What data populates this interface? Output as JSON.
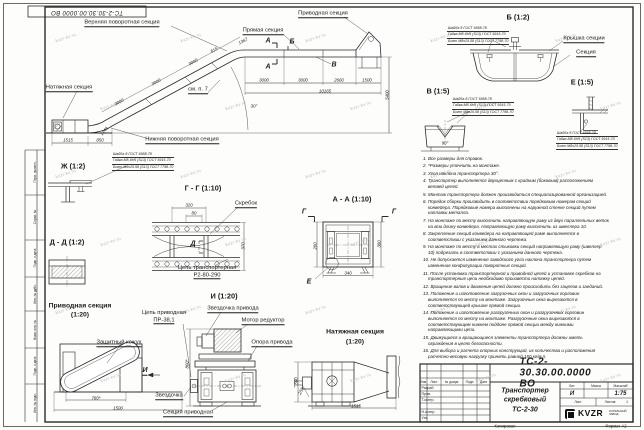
{
  "sheet": {
    "stamp_top": "ТС-2-30.30.00.0000 ВО",
    "copied_label": "Копировал",
    "format_label": "Формат А2",
    "watermark": "kvzr-kv.ru",
    "line_color": "#2b2b2b",
    "margin_labels": [
      {
        "label": "Перв. примен.",
        "y": 172
      },
      {
        "label": "Справ. №",
        "y": 217
      },
      {
        "label": "Подп. и дата",
        "y": 258
      },
      {
        "label": "Инв. № дубл.",
        "y": 294
      },
      {
        "label": "Взам. инв. №",
        "y": 330
      },
      {
        "label": "Подп. и дата",
        "y": 366
      },
      {
        "label": "Инв. № подл.",
        "y": 403
      }
    ]
  },
  "title_block": {
    "doc_number": "ТС-2-30.30.00.0000  ВО",
    "title_lines": [
      "Транспортер",
      "скребковый",
      "ТС-2-30"
    ],
    "header_cells": [
      "Изм.",
      "Лист",
      "№ докум.",
      "Подп.",
      "Дата"
    ],
    "row_labels": [
      "Разраб.",
      "Пров.",
      "Т.контр.",
      "Н.контр.",
      "Утв."
    ],
    "lit_label": "Лит.",
    "lit_value": "И",
    "mass_label": "Масса",
    "scale_label": "Масштаб",
    "scale_value": "1:75",
    "sheet_label": "Лист",
    "sheets_label": "Листов",
    "sheets_value": "1",
    "company": "KVZR",
    "company_sub_lines": [
      "КОТЕЛЬНЫЙ",
      "ЗАВОД"
    ]
  },
  "fastener_callout": [
    "Шайба 8 ГОСТ 6958-78",
    "Гайка М8-6Н5 (S13) ГОСТ 5915-70",
    "Болт М8х25.58 (S13) ГОСТ 7798-70"
  ],
  "callout_positions": [
    {
      "n": "callout-detail-b",
      "x": 447,
      "y": 26
    },
    {
      "n": "callout-detail-v",
      "x": 452,
      "y": 97
    },
    {
      "n": "callout-detail-e",
      "x": 556,
      "y": 131
    },
    {
      "n": "callout-detail-zh",
      "x": 112,
      "y": 152
    }
  ],
  "notes": [
    "1. Все размеры для справок.",
    "2. *Размеры уточнить на монтаже.",
    "3. Угол наклона транспортера 30°.",
    "4. Транспортер выполняется двухцепным с крайним (боковым) расположением ветвей цепей.",
    "5. Монтаж транспортера должен производиться специализированной организацией.",
    "6. Порядок сборки производить в соответствии порядковым номерам секций конвейера. Порядковые номера выполнены на наружной стенке секций путем наплавки металла.",
    "7. На монтаже по месту выполнить направляющую раму из двух параллельных веток на всю длину конвейера. Направляющую раму выполнить из швеллера 10.",
    "8. Закрепление секций конвейера на направляющей раме выполняется в соответствии с указанием данного чертежа.",
    "9. На монтаже по месту в местах стыковки секций направляющую раму (швеллер 10) подрезать в соответствии с указанием данного чертежа.",
    "10. Не допускается изменение заводского угла наклона транспортера путем изменения конфигурации поворотных секций.",
    "11. После установки транспортерной и приводной цепей и установке скребков на транспортерные цепи необходимо произвести натяжку цепей.",
    "12. Вращение валов и движение цепей должно происходить без зацепов и заеданий.",
    "13. Положение и изготовление загрузочных окон и загрузочных горловин выполняется по месту на монтаже. Загрузочные окна вырезаются в соответствующей крышке прямой секции.",
    "14. Положение и изготовление разгрузочных окон и разгрузочных горловин выполняется по месту на монтаже. Разгрузочные окна вырезаются в соответствующем нижнем поддоне прямой секции между нижними направляющими цепи.",
    "15. Движущиеся и вращающиеся элементы транспортера должны иметь ограждения в целях безопасности.",
    "16. Для выбора и расчета опорных конструкций, их количества и расположения расчетно-весовую нагрузку принять равной 150 кг/м.п."
  ],
  "annotations": [
    {
      "n": "label-upper-turn-section",
      "t": "Верхняя поворотная секция",
      "x": 122,
      "y": 23,
      "c": "lbl",
      "u": 1
    },
    {
      "n": "label-drive-section-main",
      "t": "Приводная секция",
      "x": 323,
      "y": 14,
      "c": "lbl",
      "u": 1
    },
    {
      "n": "label-straight-section",
      "t": "Прямая секция",
      "x": 263,
      "y": 31,
      "c": "lbl",
      "u": 1
    },
    {
      "n": "label-tension-section-main",
      "t": "Натяжная секция",
      "x": 69,
      "y": 88,
      "c": "lbl",
      "u": 1
    },
    {
      "n": "label-lower-turn-section",
      "t": "Нижняя поворотная секция",
      "x": 182,
      "y": 140,
      "c": "lbl",
      "u": 1
    },
    {
      "n": "ref-see-note-7",
      "t": "см. п. 7",
      "x": 198,
      "y": 90,
      "c": "lbl",
      "u": 1
    },
    {
      "n": "marker-a-top",
      "t": "А",
      "x": 268,
      "y": 41,
      "c": "mk"
    },
    {
      "n": "marker-a-bottom",
      "t": "А",
      "x": 268,
      "y": 67,
      "c": "mk"
    },
    {
      "n": "marker-b",
      "t": "Б",
      "x": 292,
      "y": 42,
      "c": "mk"
    },
    {
      "n": "marker-v",
      "t": "В",
      "x": 334,
      "y": 65,
      "c": "mk"
    },
    {
      "n": "dim-incline-3000-1",
      "t": "3000",
      "x": 119,
      "y": 102,
      "r": -28,
      "c": "dim"
    },
    {
      "n": "dim-incline-3000-2",
      "t": "3000",
      "x": 156,
      "y": 82,
      "r": -28,
      "c": "dim"
    },
    {
      "n": "dim-incline-3000-3",
      "t": "3000",
      "x": 193,
      "y": 62,
      "r": -28,
      "c": "dim"
    },
    {
      "n": "dim-615",
      "t": "615",
      "x": 214,
      "y": 50,
      "r": -28,
      "c": "dim"
    },
    {
      "n": "dim-1367",
      "t": "1367",
      "x": 243,
      "y": 41,
      "r": -28,
      "c": "dim"
    },
    {
      "n": "dim-1515-main",
      "t": "1515",
      "x": 68,
      "y": 140,
      "c": "dim"
    },
    {
      "n": "dim-850",
      "t": "850",
      "x": 100,
      "y": 140,
      "c": "dim"
    },
    {
      "n": "dim-1249",
      "t": "1249",
      "x": 104,
      "y": 131,
      "r": -50,
      "c": "dim"
    },
    {
      "n": "dim-straight-3000-1",
      "t": "3000",
      "x": 264,
      "y": 80,
      "c": "dim"
    },
    {
      "n": "dim-straight-3000-2",
      "t": "3000",
      "x": 303,
      "y": 80,
      "c": "dim"
    },
    {
      "n": "dim-2660",
      "t": "2660",
      "x": 339,
      "y": 80,
      "c": "dim"
    },
    {
      "n": "dim-1500-main",
      "t": "1500",
      "x": 367,
      "y": 80,
      "c": "dim"
    },
    {
      "n": "dim-10165",
      "t": "10165",
      "x": 325,
      "y": 90.5,
      "c": "dim"
    },
    {
      "n": "dim-5400",
      "t": "5400",
      "x": 387,
      "y": 95,
      "r": -90,
      "c": "dim"
    },
    {
      "n": "dim-angle-30",
      "t": "30°",
      "x": 254,
      "y": 106,
      "c": "dim"
    },
    {
      "n": "title-detail-b",
      "t": "Б (1:2)",
      "x": 518,
      "y": 17,
      "c": "ttl"
    },
    {
      "n": "label-section-cover",
      "t": "Крышка секции",
      "x": 584,
      "y": 39,
      "c": "lbl",
      "u": 1
    },
    {
      "n": "label-section",
      "t": "Секция",
      "x": 586,
      "y": 53,
      "c": "lbl",
      "u": 1
    },
    {
      "n": "title-detail-v",
      "t": "В (1:5)",
      "x": 438,
      "y": 91,
      "c": "ttl"
    },
    {
      "n": "dim-angle-90",
      "t": "90°",
      "x": 445,
      "y": 143,
      "c": "dim"
    },
    {
      "n": "title-detail-e",
      "t": "Е (1:5)",
      "x": 582,
      "y": 82,
      "c": "ttl"
    },
    {
      "n": "title-detail-zh",
      "t": "Ж (1:2)",
      "x": 73,
      "y": 166,
      "c": "ttl"
    },
    {
      "n": "title-section-gg",
      "t": "Г - Г (1:10)",
      "x": 203,
      "y": 188,
      "c": "ttl"
    },
    {
      "n": "label-scraper",
      "t": "Скребок",
      "x": 246,
      "y": 204,
      "c": "lbl",
      "u": 1
    },
    {
      "n": "label-conveyor-chain-1",
      "t": "Цепь транспортерная",
      "x": 207,
      "y": 268,
      "c": "lbl"
    },
    {
      "n": "label-conveyor-chain-2",
      "t": "Р2-80-290",
      "x": 207,
      "y": 275.5,
      "c": "lbl",
      "u": 1
    },
    {
      "n": "dim-320",
      "t": "320",
      "x": 189,
      "y": 205,
      "c": "dim"
    },
    {
      "n": "dim-80",
      "t": "80",
      "x": 194,
      "y": 213,
      "c": "dim"
    },
    {
      "n": "dim-370",
      "t": "370",
      "x": 242.5,
      "y": 246,
      "r": -90,
      "c": "dim"
    },
    {
      "n": "marker-d",
      "t": "Д",
      "x": 193,
      "y": 244,
      "c": "mk"
    },
    {
      "n": "title-section-dd",
      "t": "Д - Д (1:2)",
      "x": 67,
      "y": 242,
      "c": "ttl"
    },
    {
      "n": "title-section-aa",
      "t": "А - А (1:10)",
      "x": 352,
      "y": 199,
      "c": "ttl"
    },
    {
      "n": "marker-g-left",
      "t": "Г",
      "x": 304,
      "y": 212,
      "c": "mk"
    },
    {
      "n": "marker-g-right",
      "t": "Г",
      "x": 394,
      "y": 212,
      "c": "mk"
    },
    {
      "n": "marker-e-detail",
      "t": "Е",
      "x": 309,
      "y": 282,
      "c": "mk"
    },
    {
      "n": "dim-200",
      "t": "200",
      "x": 314.5,
      "y": 246,
      "r": -90,
      "c": "dim"
    },
    {
      "n": "dim-360",
      "t": "360",
      "x": 378.5,
      "y": 244,
      "r": -90,
      "c": "dim"
    },
    {
      "n": "dim-340",
      "t": "340",
      "x": 348,
      "y": 273,
      "c": "dim"
    },
    {
      "n": "title-drive-view-1",
      "t": "Приводная секция",
      "x": 80,
      "y": 306,
      "c": "ttl2"
    },
    {
      "n": "title-drive-view-2",
      "t": "(1:20)",
      "x": 80,
      "y": 315,
      "c": "ttl2"
    },
    {
      "n": "label-protective-casing",
      "t": "Защитный кожух",
      "x": 119,
      "y": 343,
      "c": "lbl",
      "u": 1
    },
    {
      "n": "dim-780",
      "t": "780*",
      "x": 96,
      "y": 397.5,
      "c": "dim"
    },
    {
      "n": "dim-1500-drive",
      "t": "1500",
      "x": 118,
      "y": 407.5,
      "c": "dim"
    },
    {
      "n": "marker-i-arrow",
      "t": "И",
      "x": 145,
      "y": 371,
      "c": "mk",
      "u": 1
    },
    {
      "n": "title-view-i",
      "t": "И (1:20)",
      "x": 224,
      "y": 296,
      "c": "ttl"
    },
    {
      "n": "label-drive-chain-1",
      "t": "Цепь приводная",
      "x": 164,
      "y": 313,
      "c": "lbl"
    },
    {
      "n": "label-drive-chain-2",
      "t": "ПР-38,1",
      "x": 164,
      "y": 320.5,
      "c": "lbl",
      "u": 1
    },
    {
      "n": "label-drive-sprocket",
      "t": "Звездочка привода",
      "x": 233,
      "y": 309,
      "c": "lbl",
      "u": 1
    },
    {
      "n": "label-motor-reducer",
      "t": "Мотор редуктор",
      "x": 263,
      "y": 321,
      "c": "lbl",
      "u": 1
    },
    {
      "n": "label-drive-support",
      "t": "Опора привода",
      "x": 272,
      "y": 343,
      "c": "lbl",
      "u": 1
    },
    {
      "n": "label-sprocket",
      "t": "Звездочка",
      "x": 169,
      "y": 396,
      "c": "lbl",
      "u": 1
    },
    {
      "n": "label-drive-section-view",
      "t": "Секция приводная",
      "x": 188,
      "y": 413,
      "c": "lbl",
      "u": 1
    },
    {
      "n": "dim-800",
      "t": "800*",
      "x": 187,
      "y": 364,
      "r": -90,
      "c": "dim"
    },
    {
      "n": "title-tension-view-1",
      "t": "Натяжная секция",
      "x": 355,
      "y": 332,
      "c": "ttl2"
    },
    {
      "n": "title-tension-view-2",
      "t": "(1:20)",
      "x": 355,
      "y": 342,
      "c": "ttl2"
    },
    {
      "n": "dim-560-tension",
      "t": "560",
      "x": 296,
      "y": 381,
      "r": -90,
      "c": "dim"
    },
    {
      "n": "dim-255",
      "t": "255",
      "x": 301,
      "y": 391,
      "r": -62,
      "c": "dim"
    },
    {
      "n": "dim-1515-tension",
      "t": "1515",
      "x": 356,
      "y": 405.5,
      "c": "dim"
    }
  ]
}
